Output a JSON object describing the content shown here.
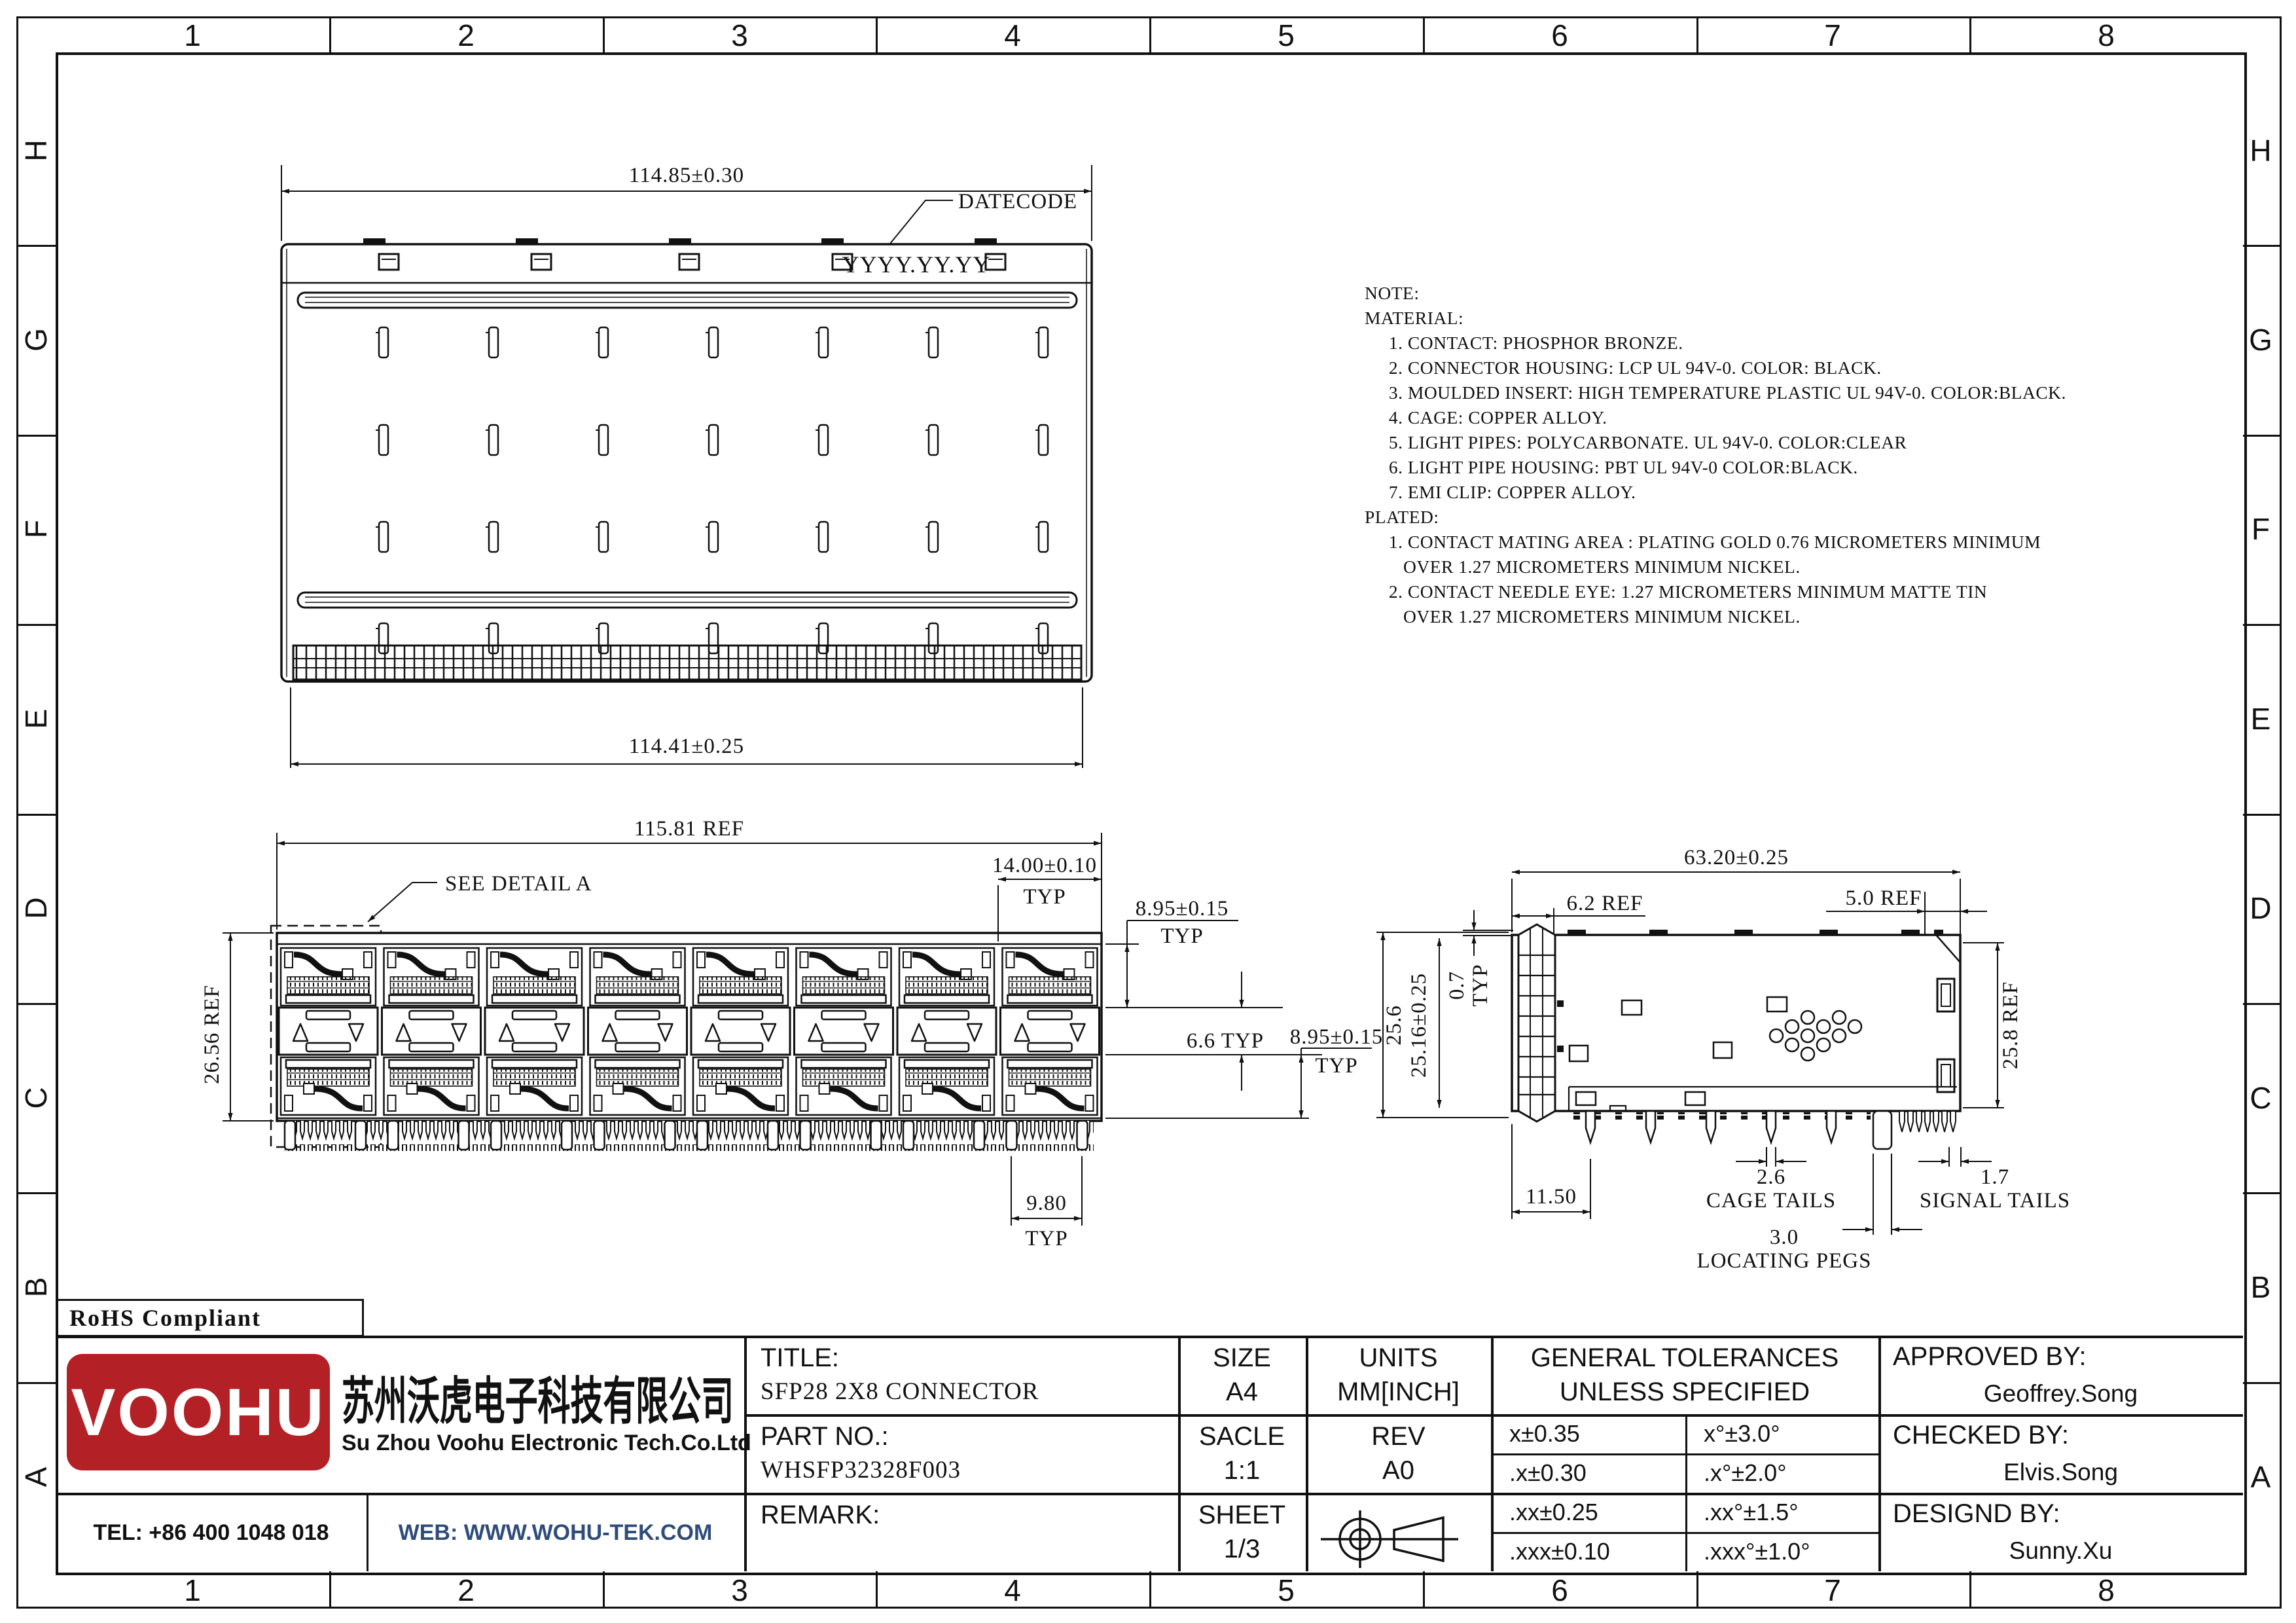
{
  "sheet": {
    "frame": {
      "columns": [
        "1",
        "2",
        "3",
        "4",
        "5",
        "6",
        "7",
        "8"
      ],
      "rows": [
        "H",
        "G",
        "F",
        "E",
        "D",
        "C",
        "B",
        "A"
      ]
    },
    "notes": {
      "lines": [
        "NOTE:",
        "MATERIAL:",
        "     1. CONTACT: PHOSPHOR BRONZE.",
        "     2. CONNECTOR HOUSING: LCP UL 94V-0. COLOR: BLACK.",
        "     3. MOULDED INSERT: HIGH TEMPERATURE PLASTIC UL 94V-0. COLOR:BLACK.",
        "     4. CAGE: COPPER ALLOY.",
        "     5. LIGHT PIPES: POLYCARBONATE. UL 94V-0. COLOR:CLEAR",
        "     6. LIGHT PIPE HOUSING: PBT UL 94V-0 COLOR:BLACK.",
        "     7. EMI CLIP: COPPER ALLOY.",
        "PLATED:",
        "     1. CONTACT MATING AREA : PLATING GOLD 0.76 MICROMETERS MINIMUM",
        "        OVER 1.27 MICROMETERS MINIMUM NICKEL.",
        "     2. CONTACT NEEDLE EYE: 1.27 MICROMETERS MINIMUM MATTE TIN",
        "        OVER 1.27 MICROMETERS MINIMUM NICKEL."
      ]
    },
    "views": {
      "top": {
        "dim_width_top": "114.85±0.30",
        "dim_width_bottom": "114.41±0.25",
        "datecode_label": "DATECODE",
        "datecode_value": "YYYY.YY.YY"
      },
      "front": {
        "dim_overall": "115.81 REF",
        "detail_callout": "SEE DETAIL A",
        "dim_height": "26.56 REF",
        "dim_pitch": "14.00±0.10",
        "dim_pitch_typ": "TYP",
        "dim_port_top": "8.95±0.15",
        "dim_port_top_typ": "TYP",
        "dim_mid": "6.6 TYP",
        "dim_port_bottom": "8.95±0.15",
        "dim_port_bottom_typ": "TYP",
        "dim_peg_pitch": "9.80",
        "dim_peg_pitch_typ": "TYP"
      },
      "side": {
        "dim_depth": "63.20±0.25",
        "dim_front": "6.2 REF",
        "dim_back": "5.0 REF",
        "dim_finger": "0.7",
        "dim_finger_typ": "TYP",
        "dim_h_outer": "25.6",
        "dim_h_cage": "25.16±0.25",
        "dim_h_rear": "25.8 REF",
        "dim_front_offset": "11.50",
        "dim_cage_tail": "2.6",
        "label_cage_tail": "CAGE TAILS",
        "dim_signal_tail": "1.7",
        "label_signal_tail": "SIGNAL TAILS",
        "dim_peg": "3.0",
        "label_peg": "LOCATING PEGS"
      }
    },
    "company": {
      "rohs": "RoHS Compliant",
      "logo_text": "VOOHU",
      "name_cn": "苏州沃虎电子科技有限公司",
      "name_en": "Su Zhou Voohu Electronic Tech.Co.Ltd",
      "tel": "TEL: +86 400 1048 018",
      "web": "WEB: WWW.WOHU-TEK.COM",
      "brand_red": "#b32025",
      "web_blue": "#2e4d7b"
    },
    "title_block": {
      "title_label": "TITLE:",
      "title_value": "SFP28 2X8 CONNECTOR",
      "part_label": "PART NO.:",
      "part_value": "WHSFP32328F003",
      "remark_label": "REMARK:",
      "size_label": "SIZE",
      "size_value": "A4",
      "units_label": "UNITS",
      "units_value": "MM[INCH]",
      "scale_label": "SACLE",
      "scale_value": "1:1",
      "rev_label": "REV",
      "rev_value": "A0",
      "sheet_label": "SHEET",
      "sheet_value": "1/3",
      "tol_header_1": "GENERAL TOLERANCES",
      "tol_header_2": "UNLESS SPECIFIED",
      "tolerances": [
        {
          "lin": "x±0.35",
          "ang": "x°±3.0°"
        },
        {
          "lin": ".x±0.30",
          "ang": ".x°±2.0°"
        },
        {
          "lin": ".xx±0.25",
          "ang": ".xx°±1.5°"
        },
        {
          "lin": ".xxx±0.10",
          "ang": ".xxx°±1.0°"
        }
      ],
      "approved_label": "APPROVED BY:",
      "approved_value": "Geoffrey.Song",
      "checked_label": "CHECKED BY:",
      "checked_value": "Elvis.Song",
      "designed_label": "DESIGND BY:",
      "designed_value": "Sunny.Xu"
    }
  }
}
